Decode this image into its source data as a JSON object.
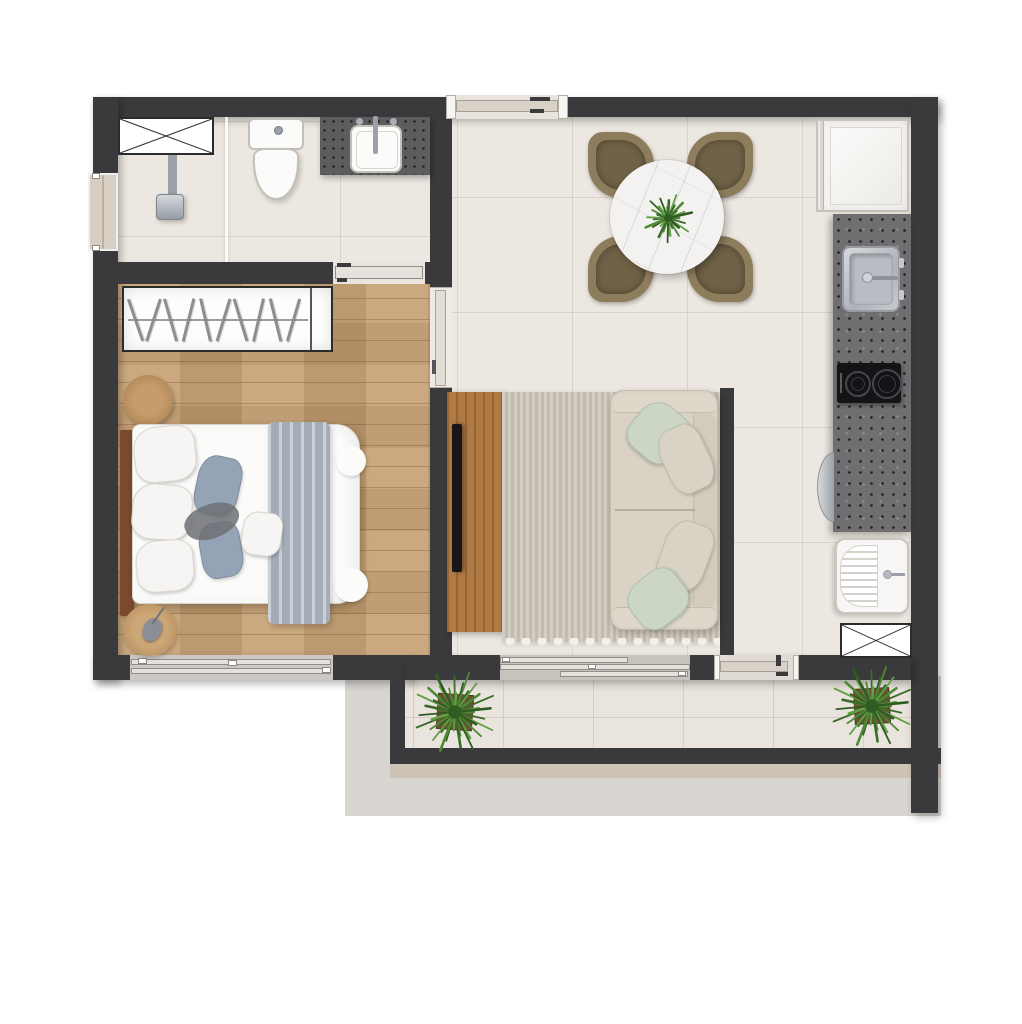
{
  "title": "Studio apartment floor plan — top-down furnished render",
  "visible_text": "",
  "colors": {
    "wall": "#3a3a3c",
    "tile_floor": "#ece7e0",
    "wood_floor": "#c49e71",
    "balcony_tile": "#e9e4dd",
    "lower_slab": "#d9d5d1",
    "countertop": "#6f6f71",
    "vanity_top": "#5d5d5f",
    "sofa": "#d9d2c5",
    "sage_pillow": "#cbd6c5",
    "chair_olive": "#8d7d5c",
    "tv_console_wood": "#b07a45",
    "rug": "#ccc5b8",
    "plant_green": "#4e8a36",
    "blanket_gray": "#adb7c2",
    "marble_table": "#f4f2f0"
  },
  "rooms": {
    "bathroom": {
      "label": "Bathroom",
      "items": [
        "ventilation shaft (crossed box)",
        "shower with glass screen",
        "wall shower head",
        "toilet",
        "dark stone vanity with white basin",
        "side-wall window"
      ]
    },
    "bedroom": {
      "label": "Bedroom",
      "items": [
        "open wardrobe with 10 hangers",
        "double bed with white duvet",
        "gray throw blanket",
        "6 pillows (white and slate)",
        "wood headboard",
        "round wooden side table",
        "round rug with decor object",
        "sliding window",
        "sliding door to living room",
        "sliding door to bathroom"
      ]
    },
    "living_dining": {
      "label": "Living / Dining room",
      "items": [
        "entry sliding door",
        "round marble dining table",
        "potted plant centerpiece",
        "4 olive dining chairs",
        "area rug with fringe",
        "3-seat sofa with 4 cushions",
        "wall-mounted TV",
        "wood TV console",
        "sliding door to balcony"
      ]
    },
    "kitchen": {
      "label": "Kitchen / Laundry strip",
      "items": [
        "refrigerator",
        "speckled stone countertop",
        "stainless kitchen sink",
        "2-burner cooktop",
        "built-in washer (half disc)",
        "laundry tank with washboard",
        "ventilation shaft (crossed box)",
        "door to balcony"
      ]
    },
    "balcony": {
      "label": "Balcony",
      "items": [
        "potted plant left",
        "potted plant right",
        "parapet wall",
        "lower slab outline"
      ]
    }
  },
  "counts": {
    "dining_chairs": 4,
    "cooktop_burners": 2,
    "balcony_plants": 2,
    "wardrobe_hangers": 10
  }
}
